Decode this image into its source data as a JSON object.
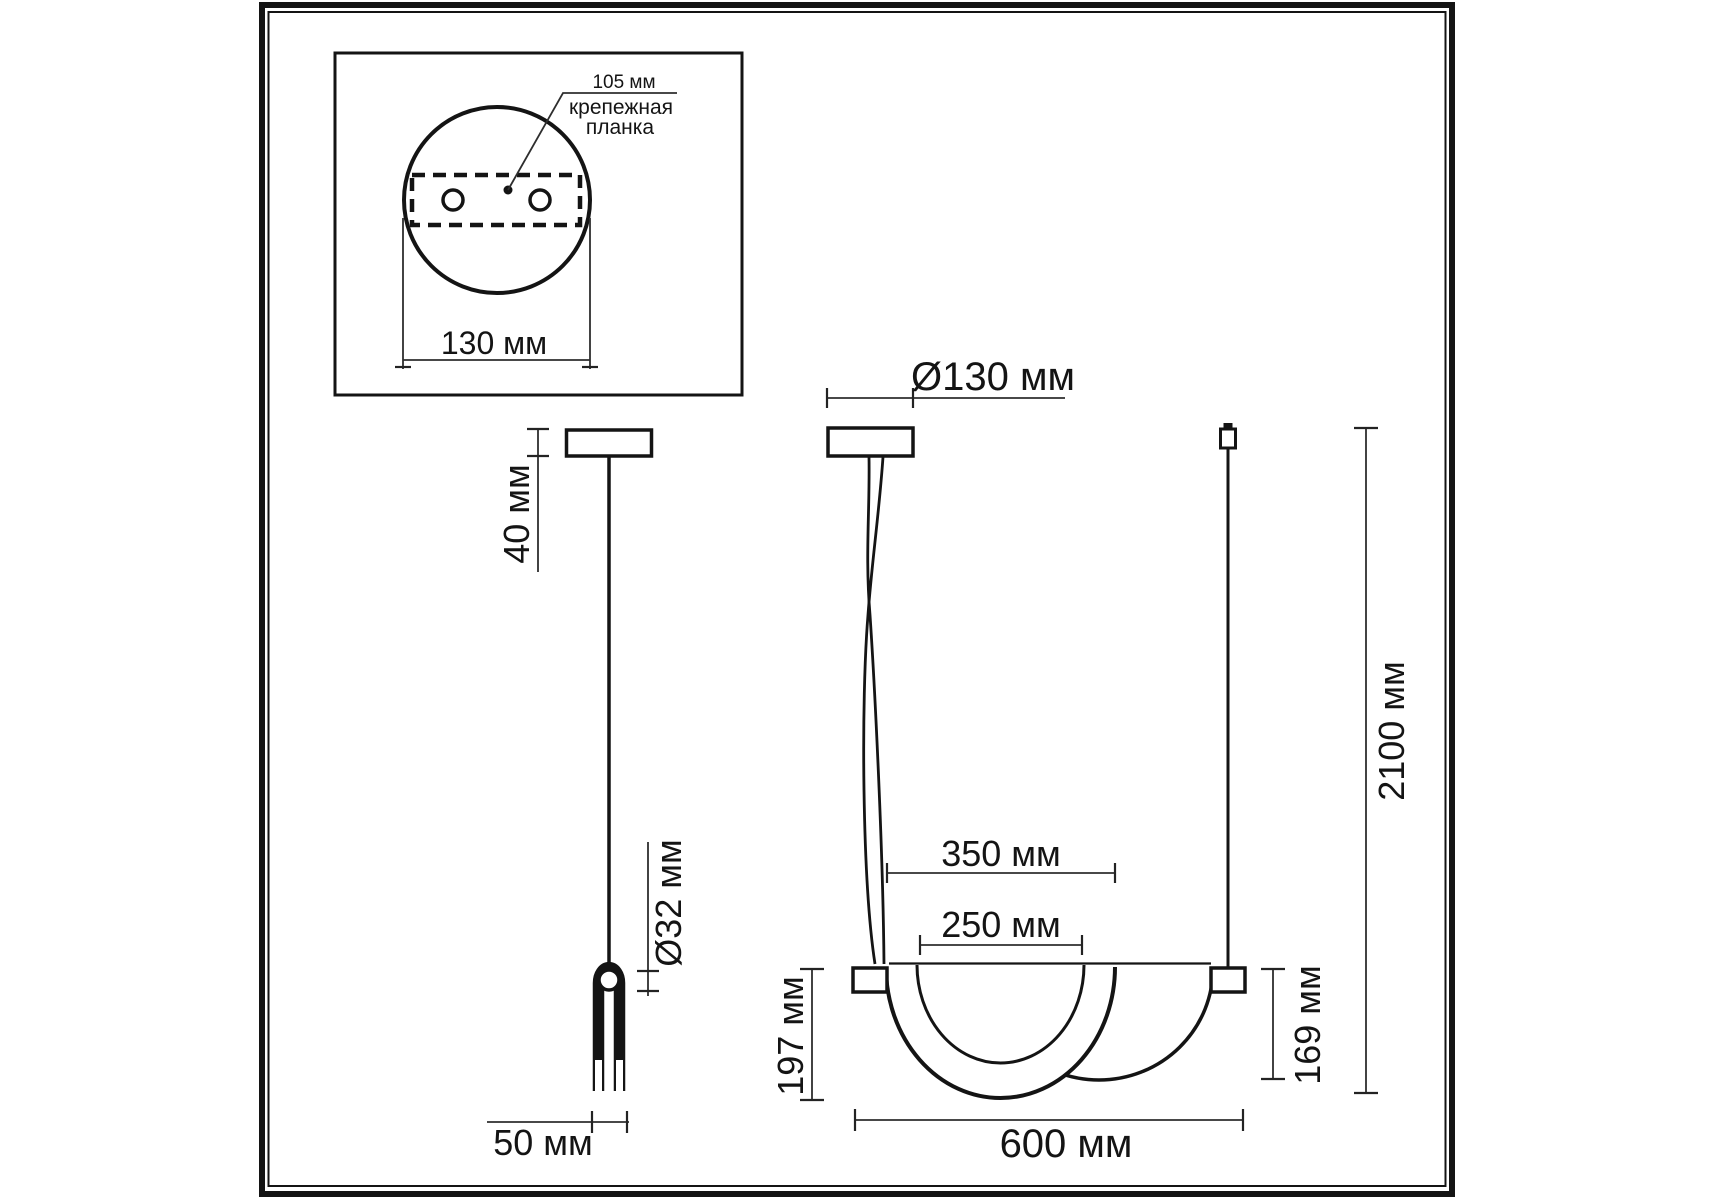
{
  "drawing": {
    "title": "Pendant light dimensional drawing",
    "language": "ru",
    "line_color": "#141414",
    "background_color": "#ffffff",
    "units": "мм"
  },
  "inset_top_view": {
    "hole_spacing_label": "105 мм",
    "mounting_plate_label_line1": "крепежная",
    "mounting_plate_label_line2": "планка",
    "canopy_width_label": "130 мм"
  },
  "side_view": {
    "canopy_height_label": "40 мм",
    "tube_diameter_label": "Ø32 мм",
    "body_depth_label": "50 мм"
  },
  "front_view": {
    "canopy_diameter_label": "Ø130 мм",
    "outer_shade_width_label": "350 мм",
    "inner_shade_width_label": "250 мм",
    "front_shade_height_label": "197 мм",
    "rear_shade_height_label": "169 мм",
    "overall_width_label": "600 мм",
    "suspension_length_label": "2100 мм"
  },
  "dimensions_mm": {
    "mounting_hole_spacing": 105,
    "canopy_diameter": 130,
    "canopy_height": 40,
    "tube_diameter": 32,
    "body_depth": 50,
    "outer_shade_width": 350,
    "inner_shade_width": 250,
    "front_shade_height": 197,
    "rear_shade_height": 169,
    "overall_width": 600,
    "suspension_length": 2100
  }
}
